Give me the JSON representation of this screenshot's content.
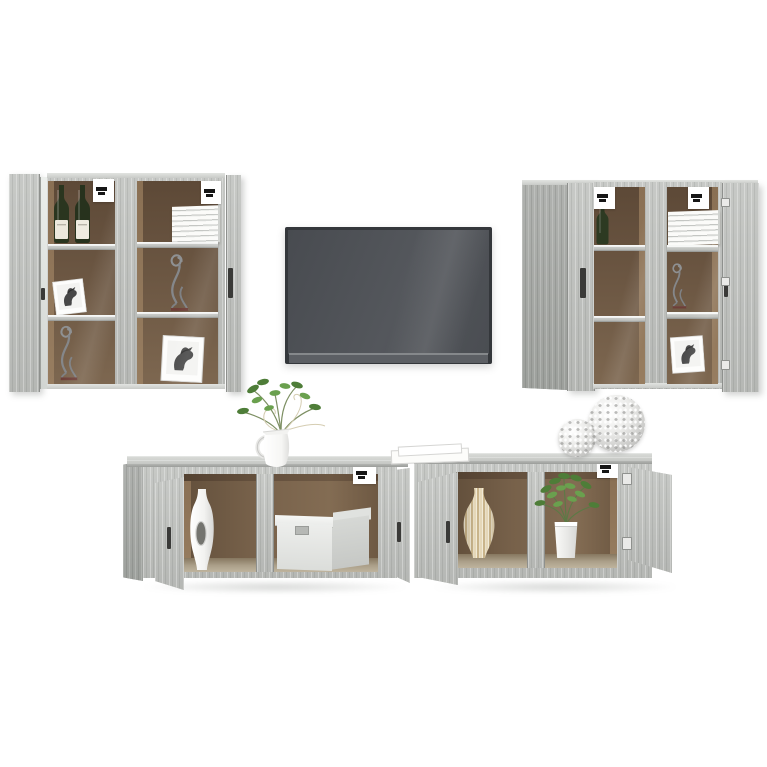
{
  "meta": {
    "kind": "product-photo",
    "subject": "Six-piece TV media wall set in grey sonoma oak look with decor items on a white studio background"
  },
  "palette": {
    "background": "#ffffff",
    "wood_grey_sonoma": "#bcbeba",
    "wood_side_panel": "#a8aaa7",
    "wood_top_face": "#cfd1ce",
    "cabinet_interior_brown": "#6b5642",
    "shelf_grey": "#c7c9c6",
    "tv_frame": "#34373b",
    "tv_screen": "#4e5156",
    "leaf_green": "#558b3c",
    "vase_stripe_beige": "#c9b48b",
    "figurine_metal": "#8f9193",
    "figurine_base_maroon": "#6e3f38",
    "card_white": "#ffffff"
  },
  "objects": {
    "tv": {
      "label": "Wall-mounted flat screen TV with dark grey screen",
      "screen_color": "#4e5156",
      "frame_color": "#34373b"
    },
    "wall_unit_left": {
      "label": "Pair of wall-hung display cabinets with open glass doors (top left)",
      "cabinet_a_contents": [
        "white mounting card",
        "two green glass bottles with white labels",
        "framed horse sketch",
        "silver wire cat figurine on maroon base"
      ],
      "cabinet_b_contents": [
        "white mounting card",
        "stack of white books",
        "silver wire cat figurine on maroon base",
        "framed horse sketch"
      ]
    },
    "wall_unit_right": {
      "label": "Pair of wall-hung display cabinets with open doors (top right)",
      "cabinet_a_contents": [
        "white mounting card",
        "green glass bottle"
      ],
      "cabinet_b_contents": [
        "white mounting card",
        "stack of white books",
        "silver wire cat figurine",
        "framed horse sketch"
      ]
    },
    "bench_left": {
      "label": "Low wall-mounted TV bench with two open doors (bottom left)",
      "contents": [
        "tall white vase with oval cut-out",
        "white storage box with lid"
      ],
      "on_top": [
        "white jug with green branches",
        "white mounting card"
      ]
    },
    "bench_right": {
      "label": "Low wall-mounted TV bench with two open doors (bottom right)",
      "contents": [
        "beige striped decorative vase",
        "green plant in white pot"
      ],
      "on_top": [
        "stack of white papers",
        "two silver openwork decorative spheres",
        "white mounting card"
      ]
    }
  }
}
